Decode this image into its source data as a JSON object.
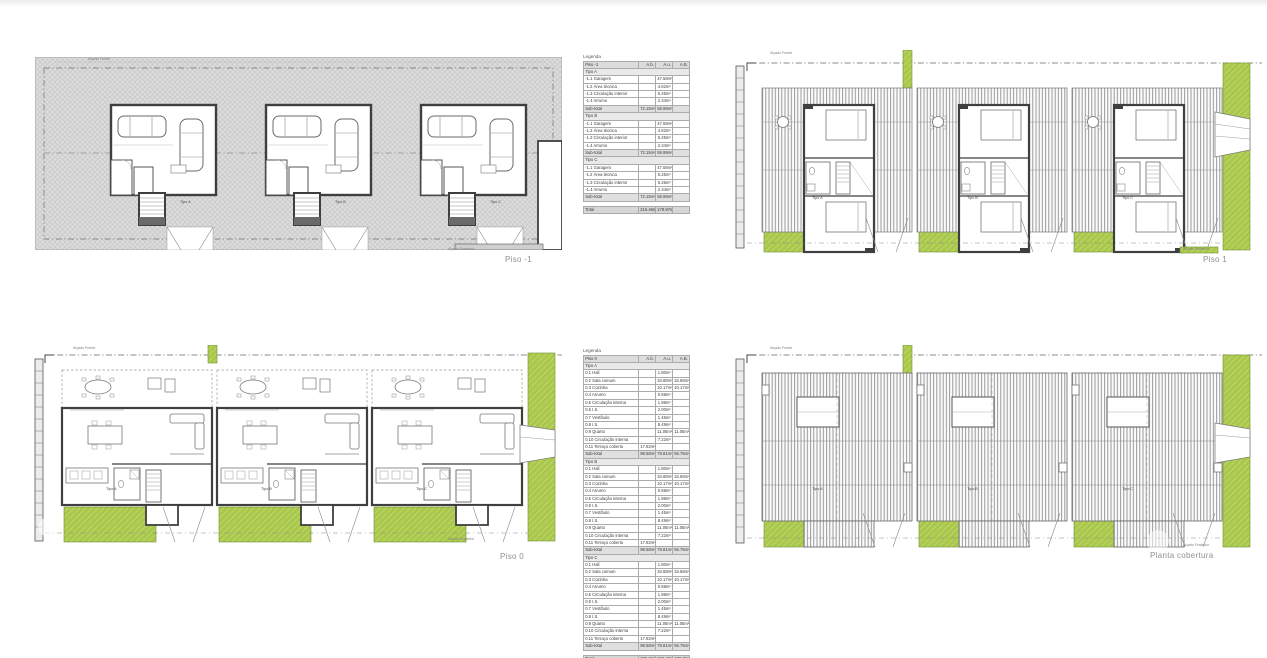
{
  "unit_labels": [
    "Tipo A",
    "Tipo B",
    "Tipo C"
  ],
  "annotations": {
    "front": "Alçado Frente",
    "back": "Alçado Posterior"
  },
  "plans": {
    "piso_m1": {
      "label": "Piso -1"
    },
    "piso_1": {
      "label": "Piso 1"
    },
    "piso_0": {
      "label": "Piso 0"
    },
    "cobertura": {
      "label": "Planta cobertura"
    }
  },
  "legends": {
    "piso_m1": {
      "title": "Legenda",
      "columns": [
        "Piso -1",
        "A.b.",
        "A.u.",
        "A.B."
      ],
      "sections": [
        {
          "name": "Tipo A",
          "rows": [
            [
              "-1.1 Garagem",
              "",
              "47.58m²",
              ""
            ],
            [
              "-1.2 Área técnica",
              "",
              "4.82m²",
              ""
            ],
            [
              "-1.3 Circulação interior",
              "",
              "5.25m²",
              ""
            ],
            [
              "-1.4 Arrumo",
              "",
              "2.34m²",
              ""
            ]
          ],
          "subtotal": [
            "Sub-total",
            "72.15m²",
            "59.99m²",
            ""
          ]
        },
        {
          "name": "Tipo B",
          "rows": [
            [
              "-1.1 Garagem",
              "",
              "47.58m²",
              ""
            ],
            [
              "-1.2 Área técnica",
              "",
              "4.82m²",
              ""
            ],
            [
              "-1.3 Circulação interior",
              "",
              "5.25m²",
              ""
            ],
            [
              "-1.4 Arrumo",
              "",
              "2.34m²",
              ""
            ]
          ],
          "subtotal": [
            "Sub-total",
            "72.15m²",
            "59.99m²",
            ""
          ]
        },
        {
          "name": "Tipo C",
          "rows": [
            [
              "-1.1 Garagem",
              "",
              "47.58m²",
              ""
            ],
            [
              "-1.2 Área técnica",
              "",
              "5.25m²",
              ""
            ],
            [
              "-1.3 Circulação interior",
              "",
              "5.25m²",
              ""
            ],
            [
              "-1.4 Arrumo",
              "",
              "2.34m²",
              ""
            ]
          ],
          "subtotal": [
            "Sub-total",
            "72.15m²",
            "59.99m²",
            ""
          ]
        }
      ],
      "total": [
        "Total",
        "216.46m²",
        "179.97m²",
        ""
      ]
    },
    "piso_0": {
      "title": "Legenda",
      "columns": [
        "Piso 0",
        "A.b.",
        "A.u.",
        "A.B."
      ],
      "sections": [
        {
          "name": "Tipo A",
          "rows": [
            [
              "0.1 Hall",
              "",
              "1.80m²",
              ""
            ],
            [
              "0.2 Sala comum",
              "",
              "34.68m²",
              "34.68m²"
            ],
            [
              "0.3 Cozinha",
              "",
              "10.17m²",
              "10.17m²"
            ],
            [
              "0.4 Arrumo",
              "",
              "0.68m²",
              ""
            ],
            [
              "0.5 Circulação interna",
              "",
              "1.98m²",
              ""
            ],
            [
              "0.6 I.S.",
              "",
              "2.00m²",
              ""
            ],
            [
              "0.7 Vestíbulo",
              "",
              "1.45m²",
              ""
            ],
            [
              "0.8 I.S.",
              "",
              "8.49m²",
              ""
            ],
            [
              "0.9 Quarto",
              "",
              "11.06m²",
              "11.06m²"
            ],
            [
              "0.10 Circulação interna",
              "",
              "7.22m²",
              ""
            ],
            [
              "0.11 Terraço coberto",
              "17.92m²",
              "",
              ""
            ]
          ],
          "subtotal": [
            "Sub-total",
            "98.58m²",
            "79.81m²",
            "56.75m²"
          ]
        },
        {
          "name": "Tipo B",
          "rows": [
            [
              "0.1 Hall",
              "",
              "1.80m²",
              ""
            ],
            [
              "0.2 Sala comum",
              "",
              "34.68m²",
              "34.68m²"
            ],
            [
              "0.3 Cozinha",
              "",
              "10.17m²",
              "10.17m²"
            ],
            [
              "0.4 Arrumo",
              "",
              "0.68m²",
              ""
            ],
            [
              "0.5 Circulação interna",
              "",
              "1.98m²",
              ""
            ],
            [
              "0.6 I.S.",
              "",
              "2.00m²",
              ""
            ],
            [
              "0.7 Vestíbulo",
              "",
              "1.45m²",
              ""
            ],
            [
              "0.8 I.S.",
              "",
              "8.49m²",
              ""
            ],
            [
              "0.9 Quarto",
              "",
              "11.06m²",
              "11.06m²"
            ],
            [
              "0.10 Circulação interna",
              "",
              "7.22m²",
              ""
            ],
            [
              "0.11 Terraço coberto",
              "17.92m²",
              "",
              ""
            ]
          ],
          "subtotal": [
            "Sub-total",
            "98.58m²",
            "79.81m²",
            "56.75m²"
          ]
        },
        {
          "name": "Tipo C",
          "rows": [
            [
              "0.1 Hall",
              "",
              "1.80m²",
              ""
            ],
            [
              "0.2 Sala comum",
              "",
              "34.68m²",
              "34.68m²"
            ],
            [
              "0.3 Cozinha",
              "",
              "10.17m²",
              "10.17m²"
            ],
            [
              "0.4 Arrumo",
              "",
              "0.68m²",
              ""
            ],
            [
              "0.5 Circulação interna",
              "",
              "1.98m²",
              ""
            ],
            [
              "0.6 I.S.",
              "",
              "2.00m²",
              ""
            ],
            [
              "0.7 Vestíbulo",
              "",
              "1.45m²",
              ""
            ],
            [
              "0.8 I.S.",
              "",
              "8.49m²",
              ""
            ],
            [
              "0.9 Quarto",
              "",
              "11.06m²",
              "11.06m²"
            ],
            [
              "0.10 Circulação interna",
              "",
              "7.22m²",
              ""
            ],
            [
              "0.11 Terraço coberto",
              "17.92m²",
              "",
              ""
            ]
          ],
          "subtotal": [
            "Sub-total",
            "98.58m²",
            "79.81m²",
            "56.75m²"
          ]
        }
      ],
      "total": [
        "Total",
        "295.74m²",
        "239.43m²",
        "170.25m²"
      ]
    }
  },
  "colors": {
    "lawn_green": "#a9c84b",
    "wall_dark": "#3f3f3f",
    "hatch_gray": "#dcdcdc",
    "label_gray": "#8f8f8f"
  }
}
